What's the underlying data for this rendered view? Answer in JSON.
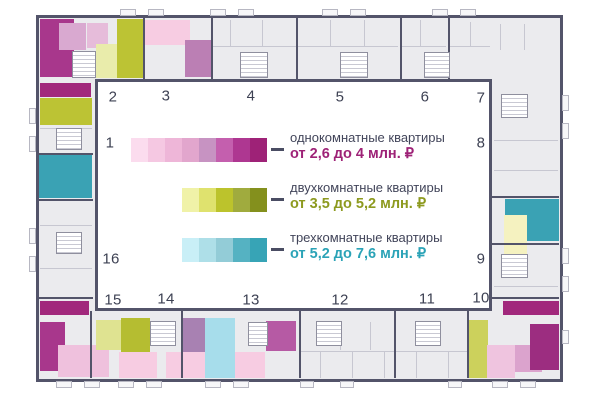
{
  "legend": {
    "items": [
      {
        "id": "one-room",
        "label": "однокомнатные квартиры",
        "price": "от 2,6 до 4 млн. ₽",
        "price_color": "#9e2277",
        "swatches": [
          "#fbdcee",
          "#f5c8e2",
          "#eeb6d8",
          "#e2a6cd",
          "#c793c2",
          "#c45fae",
          "#ae3791",
          "#9e2277"
        ],
        "pos": {
          "x": 131,
          "y": 138,
          "dash_x": 271,
          "text_x": 290,
          "text_y": 130
        }
      },
      {
        "id": "two-room",
        "label": "двухкомнатные квартиры",
        "price": "от 3,5 до 5,2 млн. ₽",
        "price_color": "#8d9a1f",
        "swatches": [
          "#f0f2a8",
          "#dfe26e",
          "#bcc32c",
          "#a0ab3e",
          "#84901d"
        ],
        "pos": {
          "x": 182,
          "y": 188,
          "dash_x": 271,
          "text_x": 290,
          "text_y": 180
        }
      },
      {
        "id": "three-room",
        "label": "трехкомнатные квартиры",
        "price": "от 5,2 до 7,6 млн. ₽",
        "price_color": "#2ba3b7",
        "swatches": [
          "#c9eff7",
          "#aedfe8",
          "#93ccd7",
          "#55b2c2",
          "#37a4b6"
        ],
        "pos": {
          "x": 182,
          "y": 238,
          "dash_x": 271,
          "text_x": 290,
          "text_y": 230
        }
      }
    ]
  },
  "sections": [
    {
      "num": "1",
      "x": 110,
      "y": 143
    },
    {
      "num": "2",
      "x": 113,
      "y": 97
    },
    {
      "num": "3",
      "x": 166,
      "y": 96
    },
    {
      "num": "4",
      "x": 251,
      "y": 96
    },
    {
      "num": "5",
      "x": 340,
      "y": 97
    },
    {
      "num": "6",
      "x": 425,
      "y": 97
    },
    {
      "num": "7",
      "x": 481,
      "y": 98
    },
    {
      "num": "8",
      "x": 481,
      "y": 143
    },
    {
      "num": "9",
      "x": 481,
      "y": 259
    },
    {
      "num": "10",
      "x": 481,
      "y": 298
    },
    {
      "num": "11",
      "x": 427,
      "y": 299
    },
    {
      "num": "12",
      "x": 340,
      "y": 300
    },
    {
      "num": "13",
      "x": 251,
      "y": 300
    },
    {
      "num": "14",
      "x": 166,
      "y": 299
    },
    {
      "num": "15",
      "x": 113,
      "y": 300
    },
    {
      "num": "16",
      "x": 111,
      "y": 259
    }
  ],
  "plan": {
    "outline_color": "#53546a",
    "band_fill": "#ebebee",
    "blocks": [
      [
        40,
        19,
        34,
        58,
        "#a8378c"
      ],
      [
        59,
        23,
        27,
        27,
        "#d9a9d0"
      ],
      [
        87,
        23,
        21,
        25,
        "#e6bcda"
      ],
      [
        96,
        44,
        21,
        34,
        "#e9ecab"
      ],
      [
        117,
        19,
        26,
        59,
        "#bcc334"
      ],
      [
        144,
        20,
        46,
        25,
        "#f7cce2"
      ],
      [
        185,
        40,
        26,
        37,
        "#bb7fb4"
      ],
      [
        40,
        83,
        51,
        14,
        "#a1287c"
      ],
      [
        40,
        98,
        52,
        27,
        "#bcc334"
      ],
      [
        39,
        155,
        53,
        43,
        "#3aa2b4"
      ],
      [
        40,
        301,
        49,
        14,
        "#a1287c"
      ],
      [
        40,
        322,
        25,
        49,
        "#a8378c"
      ],
      [
        58,
        345,
        51,
        32,
        "#efc1dd"
      ],
      [
        96,
        320,
        25,
        30,
        "#dfe391"
      ],
      [
        121,
        318,
        29,
        60,
        "#b5bd31"
      ],
      [
        119,
        352,
        38,
        26,
        "#f7cce2"
      ],
      [
        166,
        352,
        39,
        26,
        "#f7cce2"
      ],
      [
        183,
        318,
        28,
        34,
        "#a881b2"
      ],
      [
        205,
        318,
        30,
        60,
        "#a7ddeb"
      ],
      [
        235,
        352,
        30,
        26,
        "#f7cce2"
      ],
      [
        266,
        321,
        30,
        30,
        "#b65aa4"
      ],
      [
        469,
        320,
        19,
        58,
        "#ccd15c"
      ],
      [
        487,
        345,
        28,
        33,
        "#efc4df"
      ],
      [
        515,
        345,
        27,
        27,
        "#dba3cd"
      ],
      [
        530,
        324,
        29,
        46,
        "#9c2d80"
      ],
      [
        503,
        301,
        56,
        14,
        "#a1287c"
      ],
      [
        505,
        199,
        54,
        42,
        "#3aa2b4"
      ],
      [
        504,
        215,
        23,
        45,
        "#f5f2c0"
      ]
    ],
    "walls": [
      [
        213,
        46,
        83,
        1
      ],
      [
        298,
        46,
        100,
        1
      ],
      [
        402,
        46,
        44,
        1
      ],
      [
        450,
        46,
        40,
        1
      ],
      [
        230,
        20,
        1,
        26
      ],
      [
        262,
        20,
        1,
        26
      ],
      [
        330,
        20,
        1,
        26
      ],
      [
        364,
        20,
        1,
        26
      ],
      [
        420,
        20,
        1,
        26
      ],
      [
        470,
        22,
        1,
        24
      ],
      [
        500,
        24,
        1,
        26
      ],
      [
        524,
        24,
        1,
        26
      ],
      [
        494,
        140,
        64,
        1
      ],
      [
        494,
        170,
        64,
        1
      ],
      [
        494,
        286,
        64,
        1
      ],
      [
        300,
        351,
        167,
        1
      ],
      [
        320,
        352,
        1,
        26
      ],
      [
        352,
        352,
        1,
        26
      ],
      [
        384,
        352,
        1,
        26
      ],
      [
        416,
        352,
        1,
        26
      ],
      [
        448,
        352,
        1,
        26
      ],
      [
        340,
        322,
        1,
        28
      ],
      [
        370,
        322,
        1,
        28
      ],
      [
        40,
        128,
        52,
        1
      ],
      [
        40,
        225,
        52,
        1
      ],
      [
        40,
        268,
        52,
        1
      ]
    ],
    "dividers": [
      [
        143,
        18,
        2,
        61
      ],
      [
        211,
        18,
        2,
        61
      ],
      [
        296,
        18,
        2,
        61
      ],
      [
        400,
        18,
        2,
        61
      ],
      [
        448,
        18,
        2,
        61
      ],
      [
        90,
        311,
        2,
        67
      ],
      [
        181,
        311,
        2,
        67
      ],
      [
        299,
        311,
        2,
        67
      ],
      [
        394,
        311,
        2,
        67
      ],
      [
        467,
        311,
        2,
        67
      ],
      [
        39,
        153,
        54,
        2
      ],
      [
        39,
        199,
        54,
        2
      ],
      [
        39,
        297,
        54,
        2
      ],
      [
        492,
        196,
        67,
        2
      ],
      [
        492,
        243,
        67,
        2
      ],
      [
        492,
        297,
        67,
        2
      ]
    ],
    "cores": [
      [
        72,
        51,
        24,
        27
      ],
      [
        240,
        52,
        28,
        26
      ],
      [
        340,
        52,
        28,
        26
      ],
      [
        424,
        52,
        26,
        26
      ],
      [
        150,
        321,
        26,
        25
      ],
      [
        248,
        322,
        20,
        24
      ],
      [
        316,
        321,
        26,
        25
      ],
      [
        415,
        321,
        26,
        25
      ],
      [
        56,
        128,
        26,
        22
      ],
      [
        56,
        232,
        26,
        22
      ],
      [
        501,
        94,
        27,
        24
      ],
      [
        501,
        254,
        27,
        24
      ]
    ],
    "balconies": [
      [
        120,
        9,
        16,
        7
      ],
      [
        148,
        9,
        16,
        7
      ],
      [
        210,
        9,
        16,
        7
      ],
      [
        238,
        9,
        16,
        7
      ],
      [
        322,
        9,
        16,
        7
      ],
      [
        350,
        9,
        16,
        7
      ],
      [
        432,
        9,
        16,
        7
      ],
      [
        460,
        9,
        16,
        7
      ],
      [
        56,
        381,
        16,
        7
      ],
      [
        84,
        381,
        16,
        7
      ],
      [
        118,
        381,
        16,
        7
      ],
      [
        146,
        381,
        16,
        7
      ],
      [
        205,
        381,
        16,
        7
      ],
      [
        233,
        381,
        16,
        7
      ],
      [
        300,
        381,
        14,
        7
      ],
      [
        340,
        381,
        14,
        7
      ],
      [
        448,
        381,
        14,
        7
      ],
      [
        492,
        381,
        16,
        7
      ],
      [
        520,
        381,
        16,
        7
      ],
      [
        29,
        108,
        7,
        16
      ],
      [
        29,
        136,
        7,
        16
      ],
      [
        29,
        228,
        7,
        16
      ],
      [
        29,
        256,
        7,
        16
      ],
      [
        562,
        95,
        7,
        16
      ],
      [
        562,
        123,
        7,
        16
      ],
      [
        562,
        248,
        7,
        16
      ],
      [
        562,
        276,
        7,
        16
      ],
      [
        562,
        330,
        7,
        14
      ]
    ]
  }
}
